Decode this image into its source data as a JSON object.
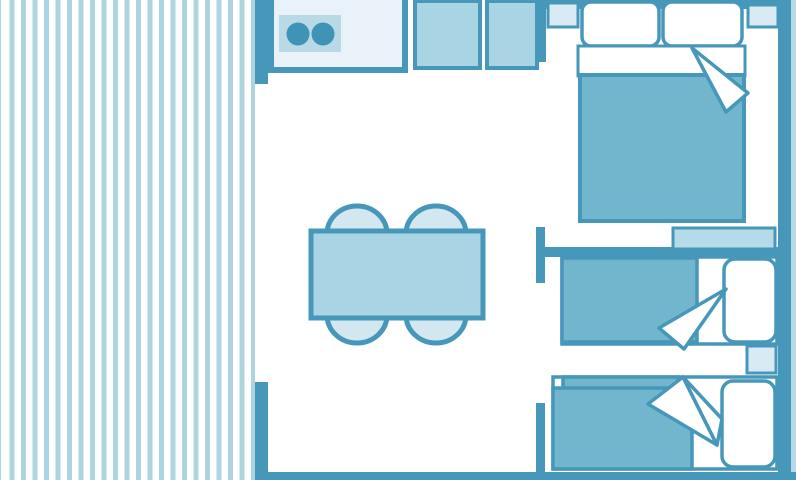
{
  "meta": {
    "type": "floor-plan",
    "description": "Top-down schematic floor plan of a holiday mobile home / chalet drawn in blue tones: striped terrace on the left, open living-kitchen area in the middle, double bedroom top right and two single-bed spaces bottom right",
    "canvas": {
      "width": 796,
      "height": 480
    }
  },
  "colors": {
    "wall": "#4697b9",
    "blanket": "#71b6cd",
    "table": "#a9d4e3",
    "chair": "#d3e7f1",
    "cabinet": "#a9d4e3",
    "stove_panel": "#b9d9e6",
    "burner": "#3f93b6",
    "counter": "#e8f2f8",
    "nightstand": "#d8eaf3",
    "shelf": "#b5dae8",
    "deck_stripe": "#aed4e0",
    "floor": "#ffffff",
    "right_edge": "#b9d8e5"
  },
  "rooms": {
    "terrace": {
      "name": "covered terrace / deck",
      "style": "vertical light-blue stripes on white"
    },
    "living_kitchen": {
      "name": "open living room with kitchenette",
      "furniture": [
        "kitchen counter with two-burner hob",
        "cabinet unit",
        "fridge / cabinet unit",
        "rectangular dining table",
        "four rounded chairs (two each long side)"
      ]
    },
    "bedroom_master": {
      "name": "double bedroom (top right)",
      "furniture": [
        "double bed with two pillows",
        "white sheet band and turned-back blanket corner",
        "left bedside table",
        "right bedside table"
      ]
    },
    "bedroom_single_1": {
      "name": "single bedroom (middle right)",
      "furniture": [
        "single bed with pillow on right",
        "turned-back blanket corner",
        "wall shelf above partition",
        "bedside table below bed"
      ]
    },
    "bedroom_single_2": {
      "name": "single bedroom (bottom right)",
      "furniture": [
        "single bed with pillow on right",
        "double-layer blanket with turned-back corner"
      ]
    }
  }
}
